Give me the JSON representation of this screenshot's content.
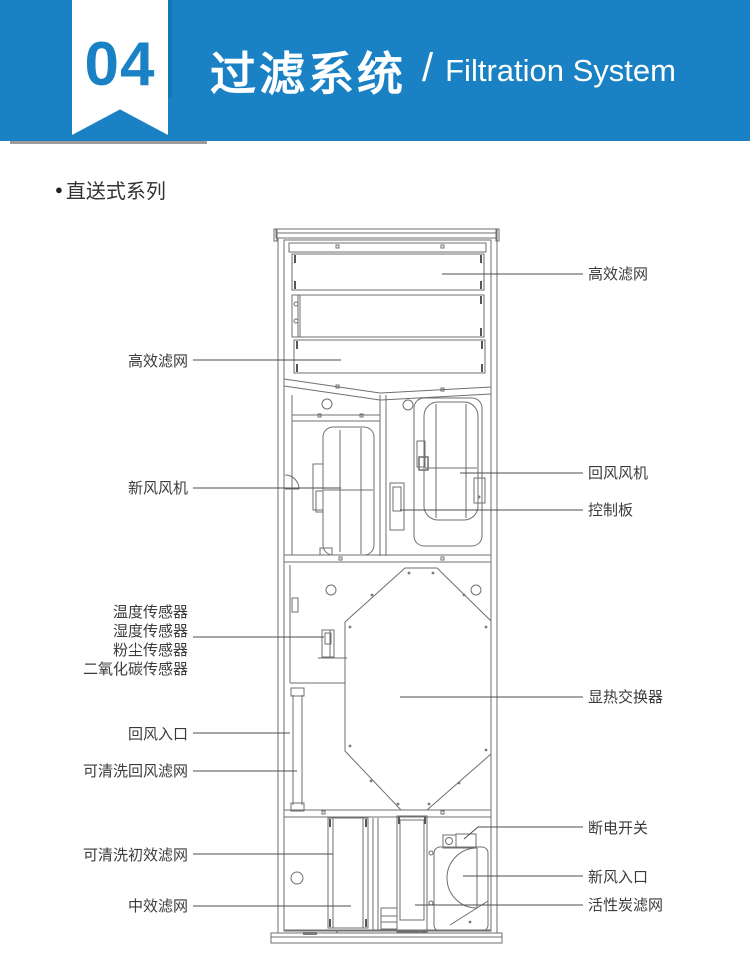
{
  "header": {
    "section_number": "04",
    "title_cn": "过滤系统",
    "separator": "/",
    "title_en": "Filtration System"
  },
  "series": {
    "bullet": "●",
    "heading": "直送式系列"
  },
  "diagram": {
    "left_labels": {
      "hepa_filter": "高效滤网",
      "fresh_air_fan": "新风风机",
      "temp_sensor": "温度传感器",
      "humidity_sensor": "湿度传感器",
      "dust_sensor": "粉尘传感器",
      "co2_sensor": "二氧化碳传感器",
      "return_air_inlet": "回风入口",
      "washable_return_filter": "可清洗回风滤网",
      "washable_primary_filter": "可清洗初效滤网",
      "medium_filter": "中效滤网"
    },
    "right_labels": {
      "hepa_filter": "高效滤网",
      "return_air_fan": "回风风机",
      "control_board": "控制板",
      "heat_exchanger": "显热交换器",
      "power_switch": "断电开关",
      "fresh_air_inlet": "新风入口",
      "carbon_filter": "活性炭滤网"
    }
  },
  "colors": {
    "header_bg": "#1a82c4",
    "header_text": "#ffffff",
    "section_number": "#1a82c4",
    "drawing_line": "#6f6f6f",
    "leader_line": "#4d4d4d",
    "label_text": "#3b3b3b"
  }
}
